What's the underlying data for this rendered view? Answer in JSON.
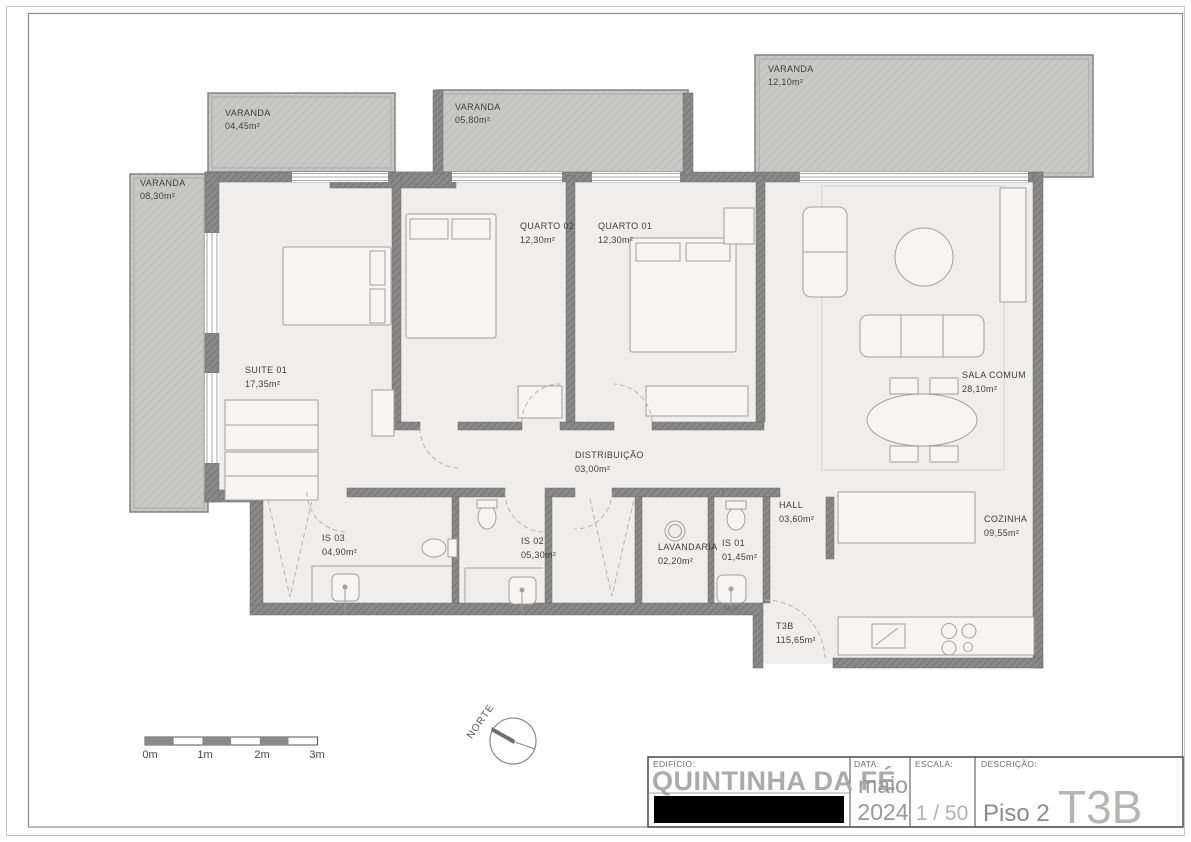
{
  "plan": {
    "balconies": [
      {
        "name": "VARANDA",
        "area": "04,45m²"
      },
      {
        "name": "VARANDA",
        "area": "05,80m²"
      },
      {
        "name": "VARANDA",
        "area": "12,10m²"
      },
      {
        "name": "VARANDA",
        "area": "08,30m²"
      }
    ],
    "rooms": [
      {
        "name": "SUITE 01",
        "area": "17,35m²"
      },
      {
        "name": "QUARTO 02",
        "area": "12,30m²"
      },
      {
        "name": "QUARTO 01",
        "area": "12,30m²"
      },
      {
        "name": "SALA COMUM",
        "area": "28,10m²"
      },
      {
        "name": "DISTRIBUIÇÃO",
        "area": "03,00m²"
      },
      {
        "name": "IS 03",
        "area": "04,90m²"
      },
      {
        "name": "IS 02",
        "area": "05,30m²"
      },
      {
        "name": "LAVANDARIA",
        "area": "02,20m²"
      },
      {
        "name": "IS 01",
        "area": "01,45m²"
      },
      {
        "name": "HALL",
        "area": "03,60m²"
      },
      {
        "name": "COZINHA",
        "area": "09,55m²"
      }
    ],
    "unit": {
      "name": "T3B",
      "area": "115,65m²"
    },
    "annotations": {
      "appliance": "MLR"
    },
    "north_label": "NORTE",
    "scale_bar_labels": [
      "0m",
      "1m",
      "2m",
      "3m"
    ]
  },
  "title_block": {
    "building_label": "EDIFÍCIO:",
    "building_name": "QUINTINHA DA FÉ",
    "date_label": "DATA:",
    "date_month": "maio",
    "date_year": "2024",
    "scale_label": "ESCALA:",
    "scale_value": "1 / 50",
    "description_label": "DESCRIÇÃO:",
    "floor": "Piso 2",
    "unit_type": "T3B"
  },
  "colors": {
    "wall": "#898989",
    "wall_hatch": "#747474",
    "balcony_fill": "#c8c8c7",
    "balcony_hatch": "#b9b9b8",
    "floor_fill": "#efeeec",
    "furniture_stroke": "#a0a09f",
    "label_text": "#3d3d3d",
    "title_gray": "#ababab"
  }
}
